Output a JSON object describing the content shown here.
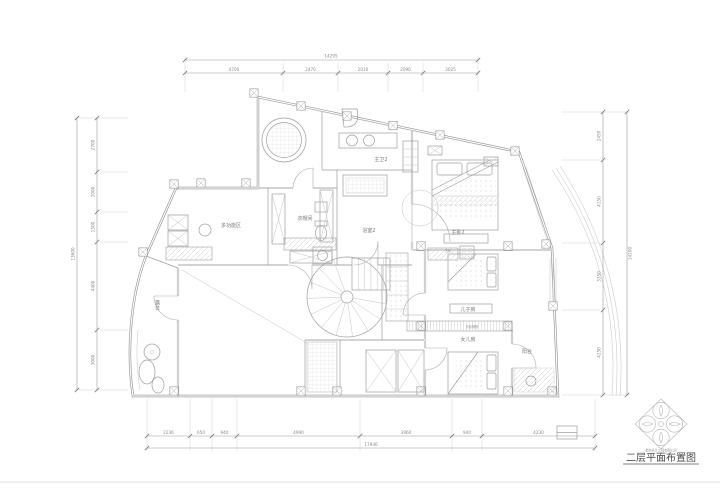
{
  "doc": {
    "title": "二层平面布置图",
    "stamp_caption": "装饰设计工程有限公司"
  },
  "rooms": {
    "multi_function": "多功能区",
    "cloakroom": "衣帽间",
    "bathroom2": "浴室2",
    "master_bath2": "主卫2",
    "master_bedroom2": "主卧2",
    "son_room": "儿子房",
    "daughter_room": "女儿房",
    "terrace": "露台",
    "balcony": "阳台"
  },
  "notes": {
    "closet": "衣柜",
    "partition": "衣柜隔断"
  },
  "dimensions": {
    "top": {
      "total": "14295",
      "segments": [
        "4700",
        "2470",
        "2010",
        "2090",
        "3025"
      ]
    },
    "bottom": {
      "total": "17946",
      "segments": [
        "2236",
        "650",
        "940",
        "4990",
        "3960",
        "940",
        "4230"
      ]
    },
    "left": {
      "total": "13600",
      "segments": [
        "2700",
        "2000",
        "1500",
        "4400",
        "3000"
      ]
    },
    "right": {
      "total": "14200",
      "segments": [
        "2450",
        "4150",
        "3350",
        "4250"
      ]
    }
  },
  "colors": {
    "background": "#ffffff",
    "wall_line": "#8a8a8a",
    "thin_line": "#9e9e9e",
    "hatch_line": "#c9c9c9",
    "dim_text": "#8a8a8a",
    "title_text": "#4a4a4a"
  }
}
